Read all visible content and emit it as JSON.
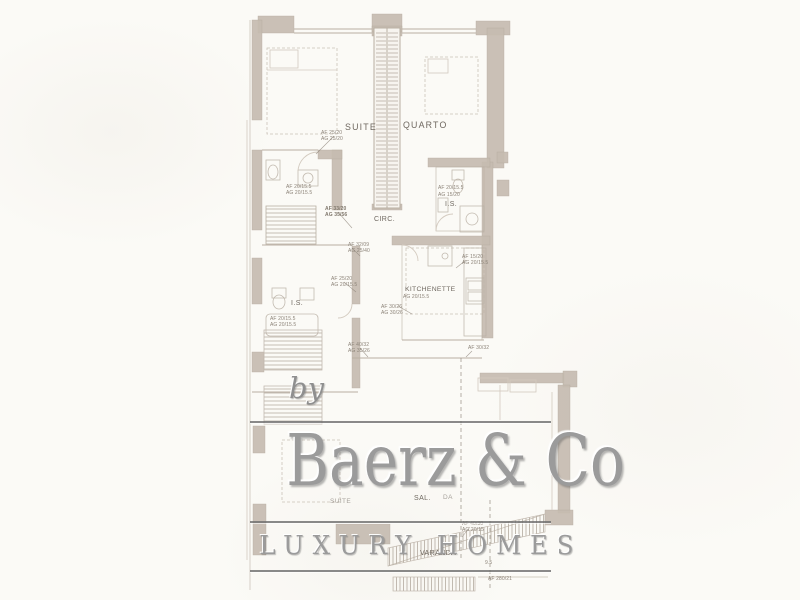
{
  "watermark": {
    "by_label": "by",
    "brand": "Baerz & Co",
    "tagline": "LUXURY HOMES"
  },
  "plan": {
    "rooms": [
      {
        "id": "suite-top",
        "label": "SUITE"
      },
      {
        "id": "quarto",
        "label": "QUARTO"
      },
      {
        "id": "circ",
        "label": "CIRC."
      },
      {
        "id": "is-right",
        "label": "I.S."
      },
      {
        "id": "kitchenette",
        "label": "KITCHENETTE"
      },
      {
        "id": "is-left",
        "label": "I.S."
      },
      {
        "id": "sala",
        "label": "SAL.",
        "label2": "DA"
      },
      {
        "id": "suite-bottom",
        "label": "SUITE"
      },
      {
        "id": "varanda",
        "label": "VARANDA"
      }
    ],
    "annotations": [
      {
        "line1": "AF 25/20",
        "line2": "AG 25/20"
      },
      {
        "line1": "AF 20/15.5",
        "line2": "AG 20/15.5"
      },
      {
        "line1": "AF 33/20",
        "line2": "AG 35/56"
      },
      {
        "line1": "AF 20/15.5",
        "line2": "AG 15/20"
      },
      {
        "line1": "AF 32/09",
        "line2": "AG 25/40"
      },
      {
        "line1": "AF 25/20",
        "line2": "AG 20/15.5"
      },
      {
        "line1": "AF 15/20",
        "line2": "AG 20/15.5"
      },
      {
        "line1": "AF 30/26",
        "line2": "AG 30/26"
      },
      {
        "line1": "AG 20/15.5",
        "line2": ""
      },
      {
        "line1": "AF 20/15.5",
        "line2": "AG 20/15.5"
      },
      {
        "line1": "AF 40/32",
        "line2": "AG 35/26"
      },
      {
        "line1": "AF 30/32",
        "line2": ""
      },
      {
        "line1": "AF 40/30",
        "line2": "AG 20/15"
      },
      {
        "line1": "AF 280/21",
        "line2": ""
      },
      {
        "line1": "9.5",
        "line2": ""
      }
    ]
  },
  "colors": {
    "paper": "#fbfaf6",
    "line": "#b9afa3",
    "lineFaint": "#d3cabf",
    "wall": "#c6bcb1",
    "wallDark": "#b2a89c",
    "label": "#6f6860",
    "anno": "#8c8378",
    "wm": "#9b9b9b",
    "rule": "#6e6e6e"
  }
}
